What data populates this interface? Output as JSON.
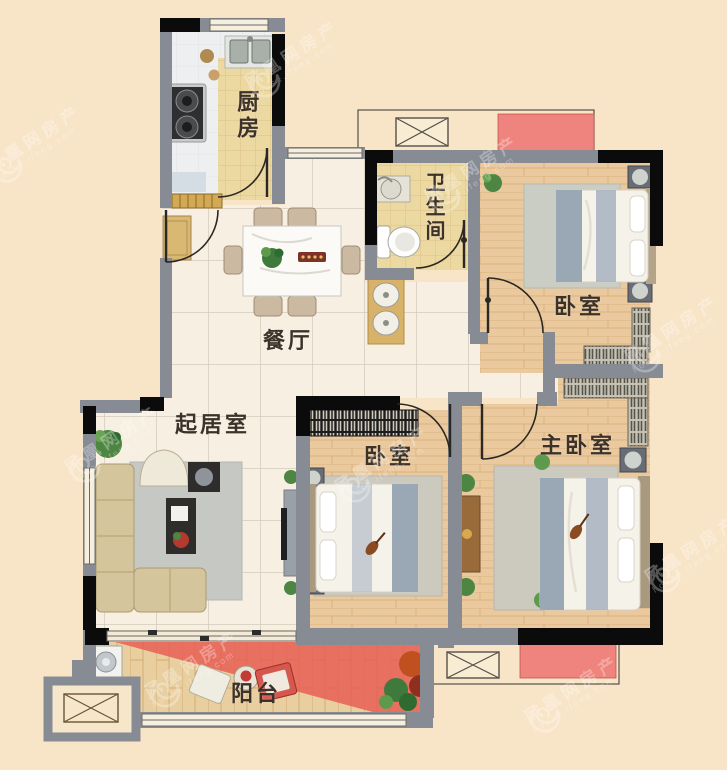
{
  "page": {
    "title": "三室两厅户型图"
  },
  "rooms": [
    {
      "id": "kitchen",
      "label": "厨房"
    },
    {
      "id": "bathroom",
      "label": "卫生间"
    },
    {
      "id": "bedroom-top",
      "label": "卧室"
    },
    {
      "id": "dining",
      "label": "餐厅"
    },
    {
      "id": "living",
      "label": "起居室"
    },
    {
      "id": "bedroom-middle",
      "label": "卧室"
    },
    {
      "id": "master-bedroom",
      "label": "主卧室"
    },
    {
      "id": "balcony",
      "label": "阳台"
    }
  ],
  "watermark": {
    "brand": "凤凰网房产",
    "domain": "house.ifeng.com"
  },
  "colors": {
    "background": "#f8e5c8",
    "wall_gray": "#878b94",
    "wall_black": "#0b0b0b",
    "highlight_red": "#e8554f",
    "platform_pink": "#ef837d",
    "wood_floor": "#ebc99e",
    "tile_cream": "#f7efe2",
    "tile_tan": "#ecd8a1",
    "label_color": "#3c3229"
  }
}
